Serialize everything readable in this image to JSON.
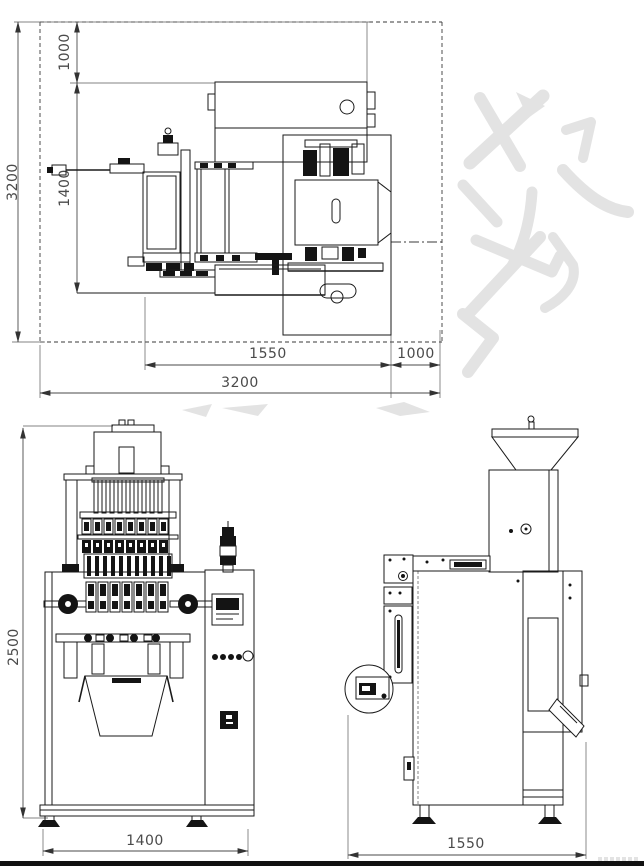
{
  "colors": {
    "background": "#ffffff",
    "linework": "#1a1a1a",
    "dimension_text": "#4a4a4a",
    "watermark": "#e3e3e3",
    "bottom_border": "#111111"
  },
  "top_view": {
    "dim_total_depth": "3200",
    "dim_rear_clearance": "1000",
    "dim_machine_depth": "1400",
    "dim_machine_width": "1550",
    "dim_side_clearance": "1000",
    "dim_total_width": "3200"
  },
  "front_view": {
    "dim_height": "2500",
    "dim_width": "1400"
  },
  "side_view": {
    "dim_depth": "1550"
  }
}
